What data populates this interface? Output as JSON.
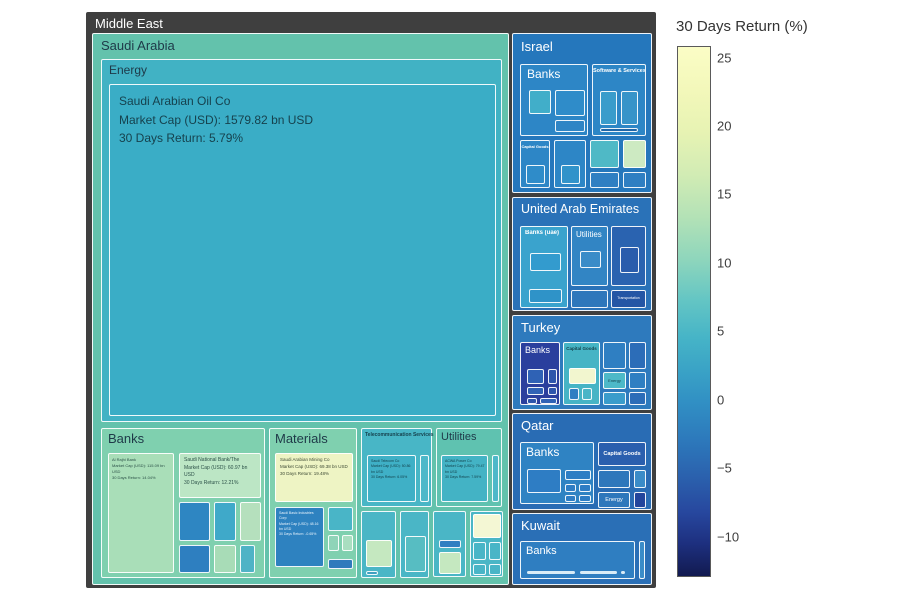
{
  "root": {
    "label": "Middle East"
  },
  "colorbar": {
    "title": "30 Days Return (%)",
    "ticks": [
      "25",
      "20",
      "15",
      "10",
      "5",
      "0",
      "−5",
      "−10"
    ]
  },
  "saudi": {
    "label": "Saudi Arabia",
    "energy": {
      "label": "Energy",
      "aramco": "Saudi Arabian Oil Co\nMarket Cap (USD): 1579.82 bn USD\n30 Days Return: 5.79%"
    },
    "banks": {
      "label": "Banks",
      "alrajhi": "Al Rajhi Bank\nMarket Cap (USD): 115.09 bn USD\n30 Days Return: 14.04%",
      "snb": "Saudi National Bank/The\nMarket Cap (USD): 60.97 bn USD\n30 Days Return: 12.21%"
    },
    "materials": {
      "label": "Materials",
      "maaden": "Saudi Arabian Mining Co\nMarket Cap (USD): 69.38 bn USD\n30 Days Return: 19.48%",
      "sabic": "Saudi Basic Industries Corp\nMarket Cap (USD): 48.16 bn USD\n30 Days Return: -0.65%"
    },
    "telecom": {
      "label": "Telecommunication Services",
      "stc": "Saudi Telecom Co\nMarket Cap (USD): 50.86 bn USD\n30 Days Return: 6.05%"
    },
    "utilities": {
      "label": "Utilities",
      "acwa": "ACWA Power Co\nMarket Cap (USD): 79.47 bn USD\n30 Days Return: 7.59%"
    }
  },
  "israel": {
    "label": "Israel",
    "banks": "Banks",
    "software": "Software & Services",
    "capital_goods": "Capital Goods"
  },
  "uae": {
    "label": "United Arab Emirates",
    "banks": "Banks (uae)",
    "utilities": "Utilities",
    "transportation": "Transportation"
  },
  "turkey": {
    "label": "Turkey",
    "banks": "Banks",
    "capital_goods": "Capital Goods",
    "energy": "Energy"
  },
  "qatar": {
    "label": "Qatar",
    "banks": "Banks",
    "capital_goods": "Capital Goods",
    "energy": "Energy"
  },
  "kuwait": {
    "label": "Kuwait",
    "banks": "Banks"
  },
  "colors": {
    "panel_bg": "#3f3f3f",
    "saudi_green": "#63c2ac",
    "sector_light_green": "#7fd0af",
    "teal": "#3aadc6",
    "pale_yellow": "#eef4c4",
    "light_green_leaf": "#a9deb8",
    "blue": "#2f83c3",
    "turkey_navy": "#2a3f9d",
    "dark_navy": "#22459c",
    "colorbar_top": "#fbfdc6",
    "colorbar_bottom": "#121a50"
  },
  "chart_data": {
    "type": "treemap",
    "title": "Middle East",
    "color_metric": "30 Days Return (%)",
    "colorbar": {
      "title": "30 Days Return (%)",
      "tick_values": [
        25,
        20,
        15,
        10,
        5,
        0,
        -5,
        -10
      ],
      "approx_range": [
        -13,
        26
      ],
      "colormap": "YlGnBu reversed (pale yellow = high return, dark navy = low return)"
    },
    "hierarchy": [
      {
        "country": "Saudi Arabia",
        "sectors": [
          {
            "sector": "Energy",
            "companies": [
              {
                "name": "Saudi Arabian Oil Co",
                "market_cap_bn_usd": 1579.82,
                "return_30d_pct": 5.79
              }
            ]
          },
          {
            "sector": "Banks",
            "companies": [
              {
                "name": "Al Rajhi Bank",
                "market_cap_bn_usd": 115.09,
                "return_30d_pct": 14.04
              },
              {
                "name": "Saudi National Bank/The",
                "market_cap_bn_usd": 60.97,
                "return_30d_pct": 12.21
              }
            ]
          },
          {
            "sector": "Materials",
            "companies": [
              {
                "name": "Saudi Arabian Mining Co",
                "market_cap_bn_usd": 69.38,
                "return_30d_pct": 19.48
              },
              {
                "name": "Saudi Basic Industries Corp",
                "market_cap_bn_usd": 48.2,
                "return_30d_pct": -0.7
              }
            ]
          },
          {
            "sector": "Telecommunication Services",
            "companies": [
              {
                "name": "Saudi Telecom Co",
                "market_cap_bn_usd": 50.86,
                "return_30d_pct": 6.0
              }
            ]
          },
          {
            "sector": "Utilities",
            "companies": [
              {
                "name": "ACWA Power Co"
              }
            ]
          }
        ]
      },
      {
        "country": "Israel",
        "sectors": [
          {
            "sector": "Banks"
          },
          {
            "sector": "Software & Services"
          },
          {
            "sector": "Capital Goods"
          }
        ]
      },
      {
        "country": "United Arab Emirates",
        "sectors": [
          {
            "sector": "Banks (uae)"
          },
          {
            "sector": "Utilities"
          },
          {
            "sector": "Transportation"
          }
        ]
      },
      {
        "country": "Turkey",
        "sectors": [
          {
            "sector": "Banks"
          },
          {
            "sector": "Capital Goods"
          },
          {
            "sector": "Energy"
          }
        ]
      },
      {
        "country": "Qatar",
        "sectors": [
          {
            "sector": "Banks"
          },
          {
            "sector": "Capital Goods"
          },
          {
            "sector": "Energy"
          }
        ]
      },
      {
        "country": "Kuwait",
        "sectors": [
          {
            "sector": "Banks"
          }
        ]
      }
    ]
  }
}
